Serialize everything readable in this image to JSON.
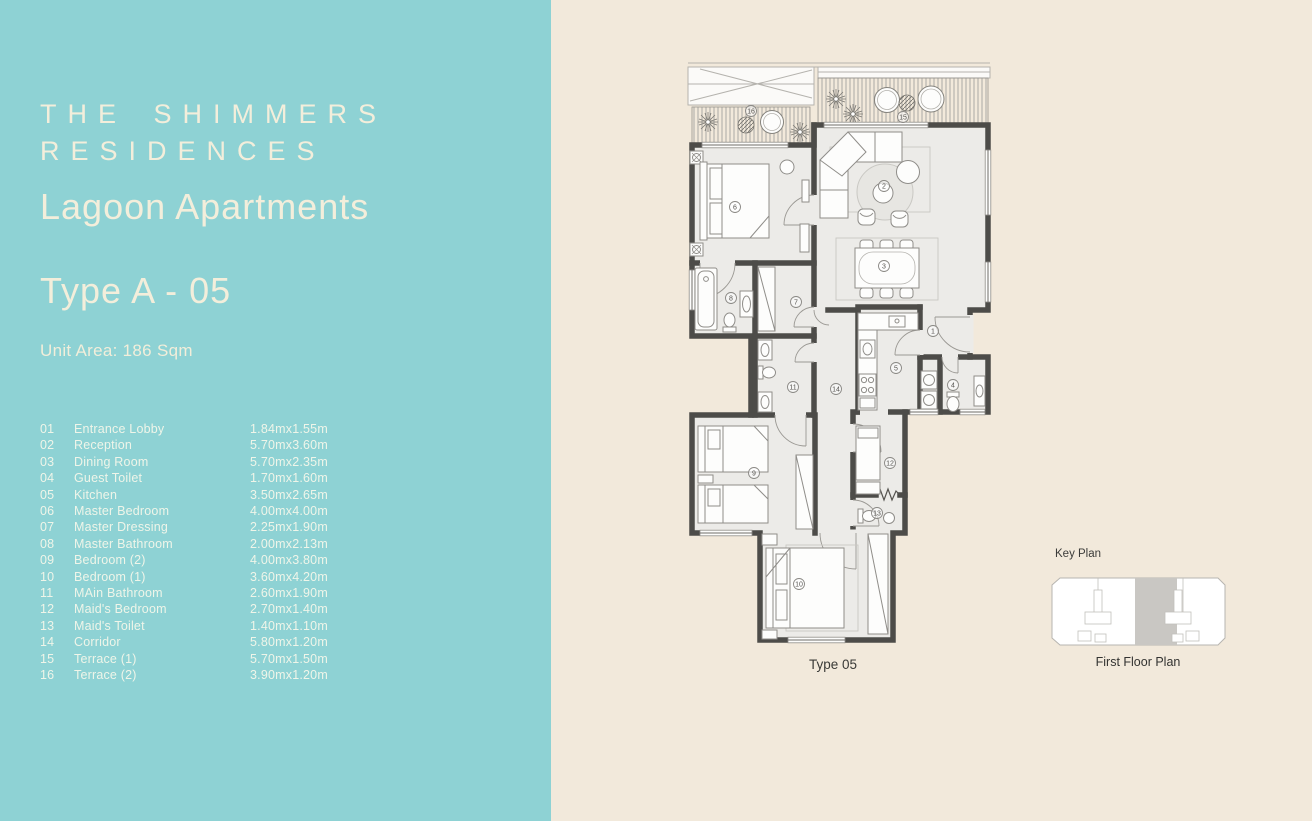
{
  "left_panel": {
    "bg_color": "#8ed2d4",
    "title_line1": "THE SHIMMERS",
    "title_line2": "RESIDENCES",
    "subtitle": "Lagoon Apartments",
    "unit_type": "Type A - 05",
    "unit_area": "Unit Area: 186 Sqm",
    "rooms": [
      {
        "no": "01",
        "name": "Entrance Lobby",
        "dim": "1.84mx1.55m"
      },
      {
        "no": "02",
        "name": "Reception",
        "dim": "5.70mx3.60m"
      },
      {
        "no": "03",
        "name": "Dining Room",
        "dim": "5.70mx2.35m"
      },
      {
        "no": "04",
        "name": "Guest Toilet",
        "dim": "1.70mx1.60m"
      },
      {
        "no": "05",
        "name": "Kitchen",
        "dim": "3.50mx2.65m"
      },
      {
        "no": "06",
        "name": "Master Bedroom",
        "dim": "4.00mx4.00m"
      },
      {
        "no": "07",
        "name": "Master Dressing",
        "dim": "2.25mx1.90m"
      },
      {
        "no": "08",
        "name": "Master Bathroom",
        "dim": "2.00mx2.13m"
      },
      {
        "no": "09",
        "name": "Bedroom (2)",
        "dim": "4.00mx3.80m"
      },
      {
        "no": "10",
        "name": "Bedroom (1)",
        "dim": "3.60mx4.20m"
      },
      {
        "no": "11",
        "name": "MAin Bathroom",
        "dim": "2.60mx1.90m"
      },
      {
        "no": "12",
        "name": "Maid's Bedroom",
        "dim": "2.70mx1.40m"
      },
      {
        "no": "13",
        "name": "Maid's Toilet",
        "dim": "1.40mx1.10m"
      },
      {
        "no": "14",
        "name": "Corridor",
        "dim": "5.80mx1.20m"
      },
      {
        "no": "15",
        "name": "Terrace (1)",
        "dim": "5.70mx1.50m"
      },
      {
        "no": "16",
        "name": "Terrace (2)",
        "dim": "3.90mx1.20m"
      }
    ]
  },
  "plan": {
    "bg_color": "#f2e9db",
    "wall_color": "#4d4c49",
    "floor_color": "#ecebe8",
    "plan_label": "Type 05",
    "circle_labels": [
      "1",
      "2",
      "3",
      "4",
      "5",
      "6",
      "7",
      "8",
      "9",
      "10",
      "11",
      "12",
      "13",
      "14",
      "15",
      "16"
    ]
  },
  "key_plan": {
    "title": "Key Plan",
    "caption": "First Floor Plan",
    "highlight_color": "#c9c7c3"
  }
}
